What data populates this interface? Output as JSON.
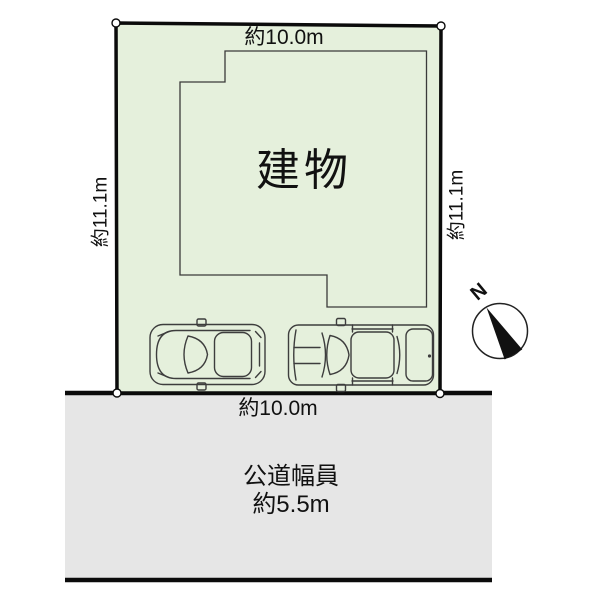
{
  "colors": {
    "plot_fill": "#e5f0dc",
    "road_fill": "#e6e6e6",
    "line": "#000000"
  },
  "plot": {
    "top_dimension": "約10.0m",
    "bottom_dimension": "約10.0m",
    "left_dimension": "約11.1m",
    "right_dimension": "約11.1m"
  },
  "building": {
    "label": "建物"
  },
  "road": {
    "name": "公道幅員",
    "width": "約5.5m"
  },
  "compass": {
    "north": "N"
  }
}
